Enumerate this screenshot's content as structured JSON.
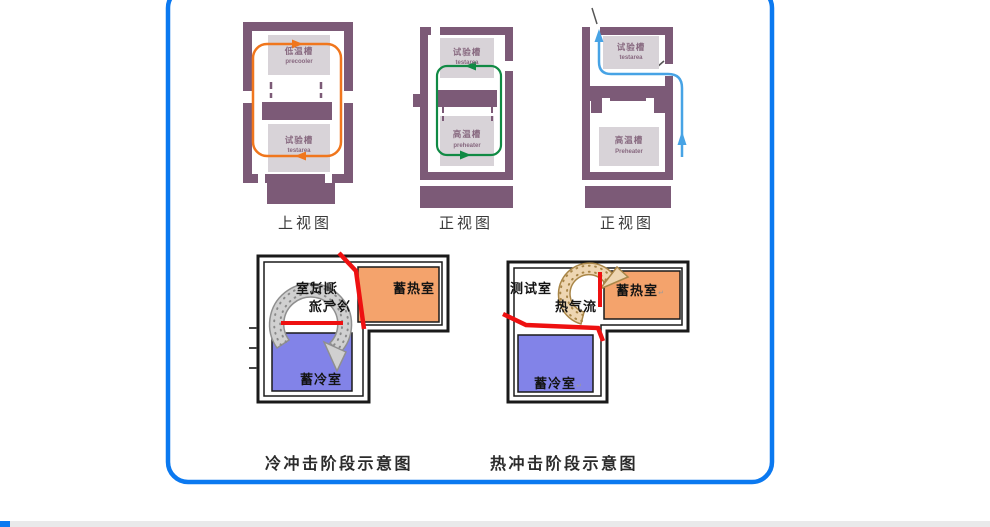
{
  "frame": {
    "border_color": "#0b79f0"
  },
  "footer": {
    "bar_color": "#e9e9ea",
    "accent_color": "#0b79f0"
  },
  "palette": {
    "wall": "#7c5a77",
    "inner_box": "#d8d3d8",
    "box_label": "#87687f",
    "orange_loop": "#f0761d",
    "green_loop": "#108a44",
    "blue_flow": "#47a3e5",
    "hot_room": "#f4a36c",
    "cold_room": "#8283e8",
    "damper_red": "#ee1111",
    "cold_ring": "#d0d0d0",
    "hot_ring": "#eed6b2"
  },
  "top_row": {
    "diagrams": [
      {
        "caption": "上视图",
        "upper_box": {
          "cn": "低温槽",
          "en": "precooler"
        },
        "lower_box": {
          "cn": "试验槽",
          "en": "testarea"
        }
      },
      {
        "caption": "正视图",
        "upper_box": {
          "cn": "试验槽",
          "en": "testarea"
        },
        "lower_box": {
          "cn": "高温槽",
          "en": "preheater"
        }
      },
      {
        "caption": "正视图",
        "upper_box": {
          "cn": "试验槽",
          "en": "testarea"
        },
        "lower_box": {
          "cn": "高温槽",
          "en": "Preheater"
        }
      }
    ]
  },
  "bottom_row": {
    "cold_shock": {
      "caption": "冷冲击阶段示意图",
      "test_room": "测试室",
      "air_flow": "冷气流",
      "heat_room": "蓄热室",
      "cold_room": "蓄冷室"
    },
    "hot_shock": {
      "caption": "热冲击阶段示意图",
      "test_room": "测试室",
      "air_flow": "热气流",
      "heat_room": "蓄热室",
      "cold_room": "蓄冷室",
      "enter_mark": "↵"
    }
  }
}
